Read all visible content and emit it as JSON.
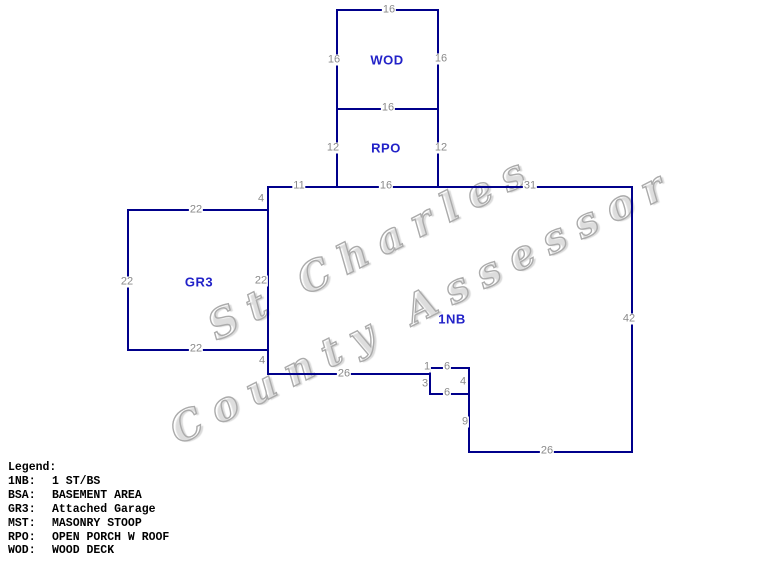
{
  "app": {
    "watermark_line1": "St Charles",
    "watermark_line2": "County Assessor"
  },
  "sketch": {
    "areas": [
      {
        "id": "wod",
        "label": "WOD"
      },
      {
        "id": "rpo",
        "label": "RPO"
      },
      {
        "id": "gr3",
        "label": "GR3"
      },
      {
        "id": "1nb",
        "label": "1NB"
      }
    ],
    "dimensions": [
      {
        "edge": "wod-top",
        "text": "16"
      },
      {
        "edge": "wod-left",
        "text": "16"
      },
      {
        "edge": "wod-right",
        "text": "16"
      },
      {
        "edge": "wod-bottom-rpo-top",
        "text": "16"
      },
      {
        "edge": "rpo-left",
        "text": "12"
      },
      {
        "edge": "rpo-right",
        "text": "12"
      },
      {
        "edge": "main-top-left-seg",
        "text": "11"
      },
      {
        "edge": "main-top-mid-seg",
        "text": "16"
      },
      {
        "edge": "main-top-right-seg",
        "text": "31"
      },
      {
        "edge": "main-left-upper-seg",
        "text": "4"
      },
      {
        "edge": "garage-top",
        "text": "22"
      },
      {
        "edge": "garage-left",
        "text": "22"
      },
      {
        "edge": "garage-right",
        "text": "22"
      },
      {
        "edge": "garage-bottom",
        "text": "22"
      },
      {
        "edge": "main-left-lower-seg",
        "text": "4"
      },
      {
        "edge": "main-bottom-left",
        "text": "26"
      },
      {
        "edge": "stoop-left-upper",
        "text": "1"
      },
      {
        "edge": "stoop-top",
        "text": "6"
      },
      {
        "edge": "stoop-left-lower",
        "text": "3"
      },
      {
        "edge": "stoop-right",
        "text": "4"
      },
      {
        "edge": "stoop-bottom",
        "text": "6"
      },
      {
        "edge": "main-right-lower-seg",
        "text": "9"
      },
      {
        "edge": "main-bottom-right",
        "text": "26"
      },
      {
        "edge": "main-right",
        "text": "42"
      }
    ]
  },
  "legend": {
    "title": "Legend:",
    "entries": [
      {
        "abbr": "1NB:",
        "desc": "1 ST/BS"
      },
      {
        "abbr": "BSA:",
        "desc": "BASEMENT AREA"
      },
      {
        "abbr": "GR3:",
        "desc": "Attached Garage"
      },
      {
        "abbr": "MST:",
        "desc": "MASONRY STOOP"
      },
      {
        "abbr": "RPO:",
        "desc": "OPEN PORCH W ROOF"
      },
      {
        "abbr": "WOD:",
        "desc": "WOOD DECK"
      }
    ]
  },
  "colors": {
    "line": "#00008b",
    "area_label": "#2222c8",
    "dimension_label": "#8a8a8a",
    "legend_text": "#000000",
    "watermark": "#ababab"
  }
}
